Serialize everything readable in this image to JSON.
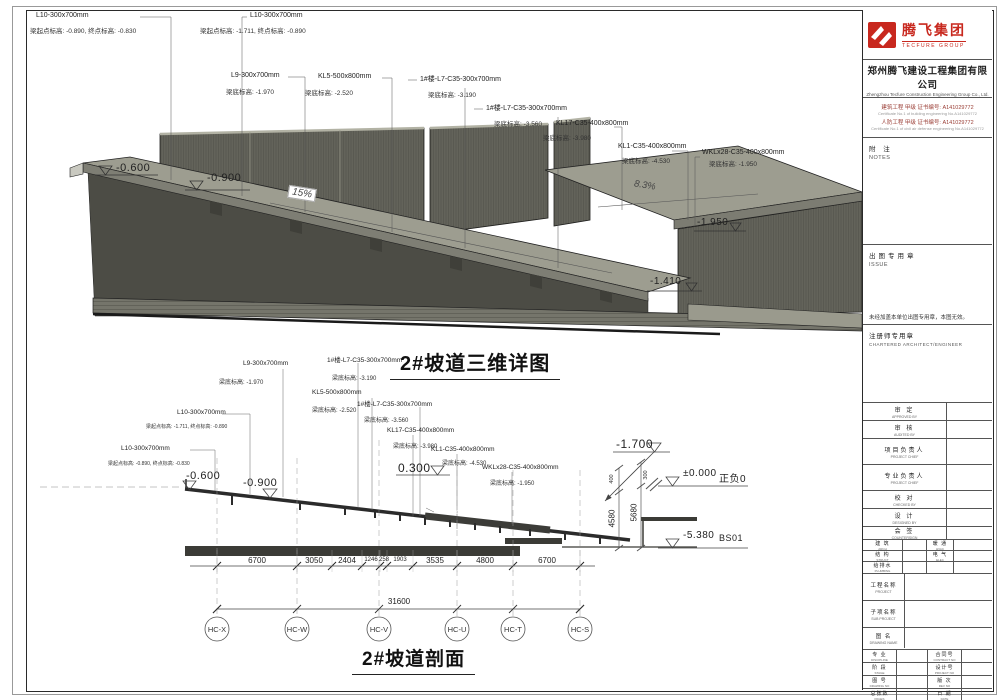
{
  "view3d": {
    "title": "2#坡道三维详图",
    "annotations": [
      {
        "name": "L10-300x700mm",
        "detail": "梁起点标高: -0.890, 终点标高: -0.830"
      },
      {
        "name": "L10-300x700mm",
        "detail": "梁起点标高: -1.711, 终点标高: -0.890"
      },
      {
        "name": "L9-300x700mm",
        "detail": "梁底标高: -1.970"
      },
      {
        "name": "KL5-500x800mm",
        "detail": "梁底标高: -2.520"
      },
      {
        "name": "1#楼-L7-C35-300x700mm",
        "detail": "梁底标高: -3.190"
      },
      {
        "name": "1#楼-L7-C35-300x700mm",
        "detail": "梁底标高: -3.560"
      },
      {
        "name": "KL17-C35-400x800mm",
        "detail": "梁底标高: -3.980"
      },
      {
        "name": "KL1-C35-400x800mm",
        "detail": "梁底标高: -4.530"
      },
      {
        "name": "WKLx28-C35-400x800mm",
        "detail": "梁底标高: -1.950"
      }
    ],
    "levels": {
      "l1": "-0.600",
      "l2": "-0.900",
      "l3": "-1.950",
      "l4": "-1.410"
    },
    "slopes": {
      "s1": "15%",
      "s2": "8.3%"
    }
  },
  "section": {
    "title": "2#坡道剖面",
    "annotations": [
      {
        "name": "L9-300x700mm",
        "detail": "梁底标高: -1.970"
      },
      {
        "name": "1#楼-L7-C35-300x700mm",
        "detail": "梁底标高: -3.190"
      },
      {
        "name": "KL5-500x800mm",
        "detail": "梁底标高: -2.520"
      },
      {
        "name": "1#楼-L7-C35-300x700mm",
        "detail": "梁底标高: -3.560"
      },
      {
        "name": "L10-300x700mm",
        "detail": "梁起点标高: -1.711, 终点标高: -0.890"
      },
      {
        "name": "L10-300x700mm",
        "detail": "梁起点标高: -0.890, 终点标高: -0.830"
      },
      {
        "name": "KL17-C35-400x800mm",
        "detail": "梁底标高: -3.980"
      },
      {
        "name": "KL1-C35-400x800mm",
        "detail": "梁底标高: -4.530"
      },
      {
        "name": "WKLx28-C35-400x800mm",
        "detail": "梁底标高: -1.950"
      },
      {
        "name": "WKLx29-C35-300x1100mm",
        "detail": ""
      }
    ],
    "levels": {
      "l1": "-0.600",
      "l2": "-0.900",
      "l3": "0.300",
      "l4": "-1.700",
      "l5": "±0.000",
      "l5_name": "正负0",
      "l6": "-5.380",
      "l6_name": "BS01"
    },
    "vdims": {
      "d1": "400",
      "d2": "300",
      "d3": "4580",
      "d4": "5680"
    },
    "dims": [
      "6700",
      "3050",
      "2404",
      "1246",
      "258",
      "1903",
      "3535",
      "4800",
      "6700"
    ],
    "total": "31600",
    "grids": [
      "HC-X",
      "HC-W",
      "HC-V",
      "HC-U",
      "HC-T",
      "HC-S"
    ]
  },
  "title_block": {
    "logo": {
      "cn": "腾飞集团",
      "en": "TECFURE GROUP"
    },
    "company": {
      "cn": "郑州腾飞建设工程集团有限公司",
      "en": "Zhengzhou Tecfure Construction Engineering Group Co., Ltd."
    },
    "certs": [
      {
        "cn": "建筑工程 甲级 证书编号: A141029772",
        "en": "Certificate No.1 of building engineering No.A141029772"
      },
      {
        "cn": "人防工程 甲级 证书编号: A141029772",
        "en": "Certificate No.1 of civil air defense engineering No.A141029772"
      }
    ],
    "notes": {
      "cn": "附 注",
      "en": "NOTES"
    },
    "issue": {
      "cn": "出图专用章",
      "en": "ISSUE",
      "note": "未经加盖本单位出图专用章，本图无效。"
    },
    "chartered": {
      "cn": "注册师专用章",
      "en": "CHARTERED ARCHITECT/ENGINEER"
    },
    "personnel": [
      {
        "cn": "审 定",
        "en": "APPROVED BY"
      },
      {
        "cn": "审 核",
        "en": "AUDITED BY"
      },
      {
        "cn": "项目负责人",
        "en": "PROJECT CHIEF"
      },
      {
        "cn": "专业负责人",
        "en": "PROJECT CHIEF"
      },
      {
        "cn": "校 对",
        "en": "CHECKED BY"
      },
      {
        "cn": "设 计",
        "en": "DESIGNED BY"
      },
      {
        "cn": "会 签",
        "en": "COUNTERSIGN"
      }
    ],
    "disciplines": [
      {
        "cn": "建 筑",
        "en": "ARCH"
      },
      {
        "cn": "暖 通",
        "en": "HVAC"
      },
      {
        "cn": "结 构",
        "en": "STRUCT"
      },
      {
        "cn": "电 气",
        "en": "ELEC"
      },
      {
        "cn": "给排水",
        "en": "PLUMBING"
      },
      {
        "cn": "",
        "en": ""
      }
    ],
    "project_rows": [
      {
        "cn": "工程名称",
        "en": "PROJECT"
      },
      {
        "cn": "子项名称",
        "en": "SUB PROJECT"
      },
      {
        "cn": "图 名",
        "en": "DRAWING NAME"
      }
    ],
    "meta_rows": [
      {
        "cn": "专 业",
        "en": "DISCIPLINE",
        "cn2": "合同号",
        "en2": "CONTRACT NO"
      },
      {
        "cn": "阶 段",
        "en": "STAGE",
        "cn2": "设计号",
        "en2": "PROJECT NO"
      },
      {
        "cn": "图 号",
        "en": "DRAWING NO",
        "cn2": "版 次",
        "en2": "REV NO"
      },
      {
        "cn": "总张数",
        "en": "PAGES",
        "cn2": "日 期",
        "en2": "DATE"
      }
    ]
  }
}
